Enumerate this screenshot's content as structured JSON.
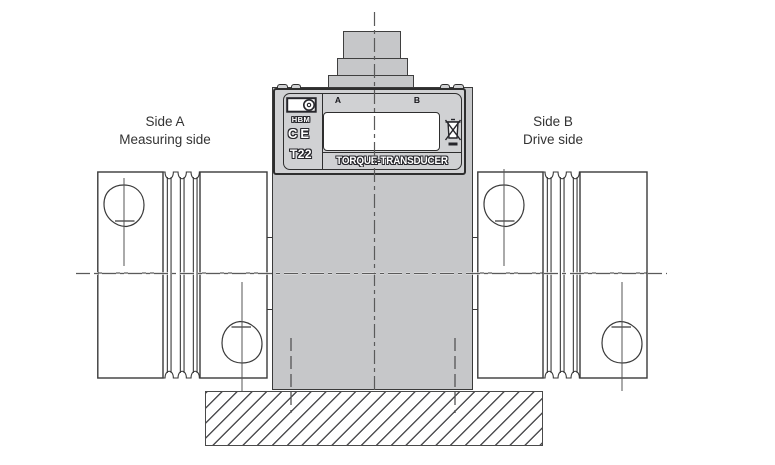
{
  "captions": {
    "side_a_line1": "Side A",
    "side_a_line2": "Measuring side",
    "side_b_line1": "Side B",
    "side_b_line2": "Drive side"
  },
  "transducer_label": {
    "brand": "HBM",
    "ce_mark": "CE",
    "model": "T22",
    "port_a": "A",
    "port_b": "B",
    "product_name": "TORQUE-TRANSDUCER"
  },
  "icons": {
    "hbm_logo": "rectangle-with-lens-circle",
    "weee": "crossed-out-wheelie-bin-with-bar",
    "coupling_hole": "teardrop-screw-hole",
    "bellows": "three-convolution-bellows"
  },
  "colors": {
    "body_fill": "#c6c7c9",
    "housing_fill": "#d0d1d3",
    "outline_dark": "#2e2e2e",
    "line_medium": "#3a3a3a",
    "centerline_gray": "#5a5a5a",
    "nameplate_fill": "#ffffff",
    "background": "#ffffff"
  }
}
